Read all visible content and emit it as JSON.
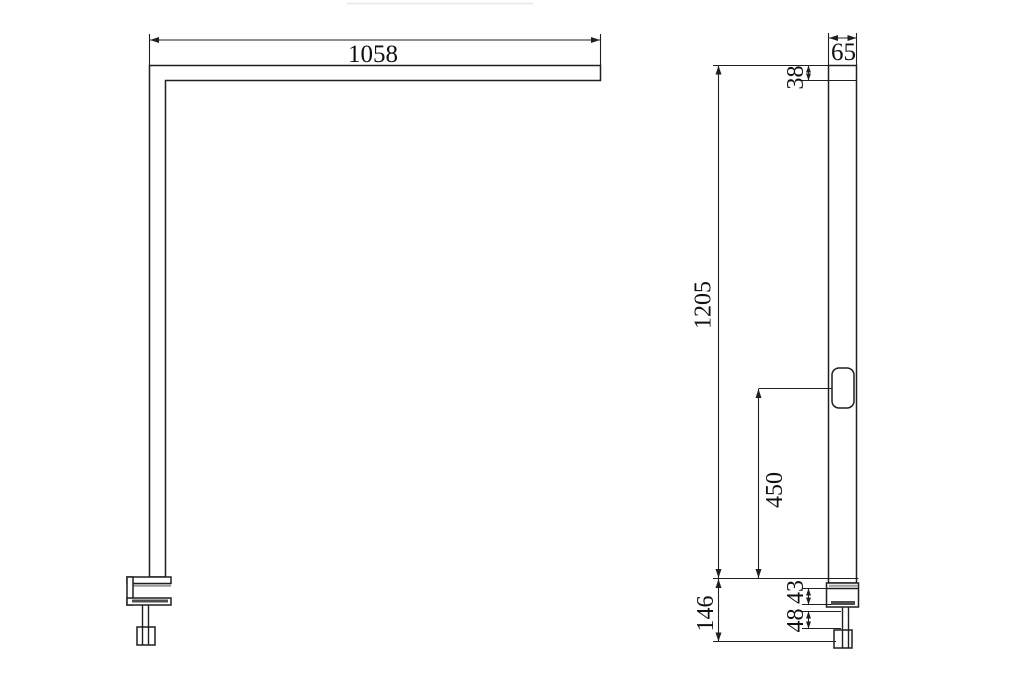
{
  "drawing": {
    "front_view": {
      "dimensions": {
        "arm_length": "1058"
      }
    },
    "side_view": {
      "dimensions": {
        "head_width": "65",
        "head_thickness": "38",
        "total_height": "1205",
        "switch_to_desk": "450",
        "clamp_section_height": "146",
        "clamp_opening": "43",
        "screw_length": "48"
      }
    }
  },
  "colors": {
    "line": "#1f1f1f",
    "shadow": "#9a9a9a",
    "pad_fill": "#4d4d4d",
    "background": "#ffffff",
    "faint_line": "#ececec"
  }
}
